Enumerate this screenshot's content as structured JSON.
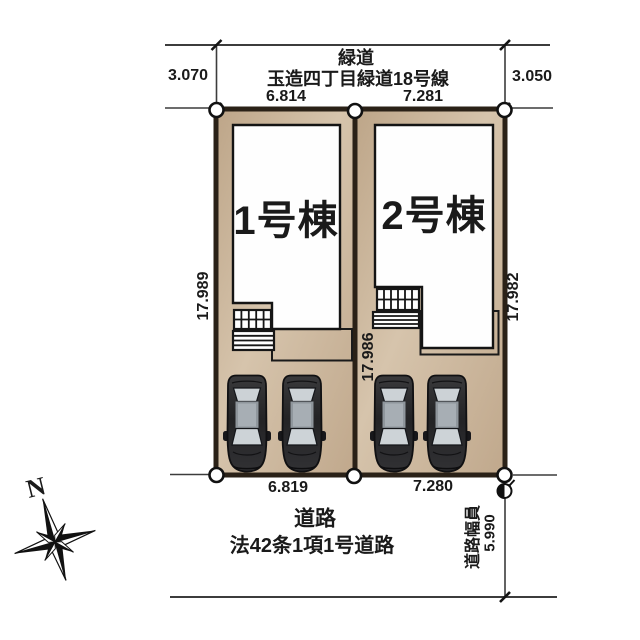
{
  "colors": {
    "lot_fill": "#cdb79c",
    "lot_border": "#2a2117",
    "building_fill": "#ffffff",
    "outline": "#1a1a1a",
    "car_body": "#2b2b2d",
    "car_glass": "#ccd2d6",
    "dimension_line": "#3c3c3c"
  },
  "compass": {
    "north_label": "N"
  },
  "green_road": {
    "name": "緑道",
    "route_name": "玉造四丁目緑道18号線",
    "width_left": "3.070",
    "width_right": "3.050"
  },
  "lots": [
    {
      "label": "1号棟",
      "frontage_top": "6.814",
      "frontage_bottom": "6.819",
      "side_depth": "17.989"
    },
    {
      "label": "2号棟",
      "frontage_top": "7.281",
      "frontage_bottom": "7.280",
      "side_depth": "17.982"
    }
  ],
  "divider": {
    "depth": "17.986"
  },
  "road": {
    "name": "道路",
    "legal_class": "法42条1項1号道路",
    "width_caption": "道路幅員",
    "width_value": "5.990"
  }
}
